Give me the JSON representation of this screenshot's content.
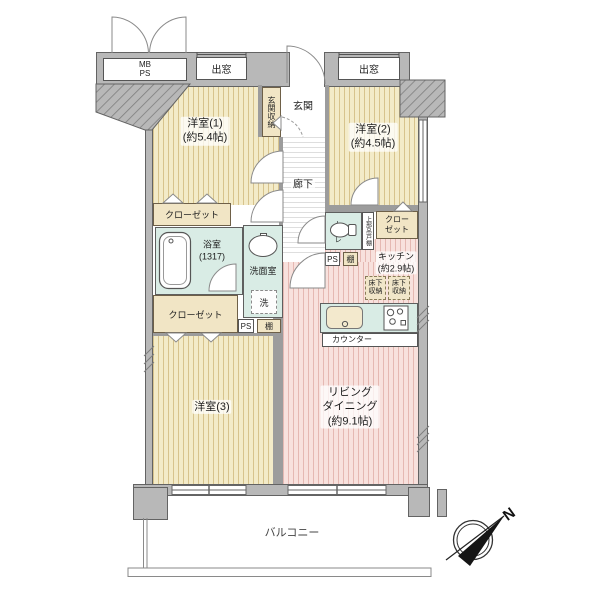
{
  "floorplan": {
    "rooms": {
      "room1": {
        "name": "洋室(1)",
        "size": "(約5.4帖)"
      },
      "room2": {
        "name": "洋室(2)",
        "size": "(約4.5帖)"
      },
      "room3": {
        "name": "洋室(3)"
      },
      "living": {
        "name_line1": "リビング",
        "name_line2": "ダイニング",
        "size": "(約9.1帖)"
      },
      "kitchen": {
        "name": "キッチン",
        "size": "(約2.9帖)"
      },
      "bath": {
        "name": "浴室",
        "size": "(1317)"
      },
      "washroom": {
        "name": "洗面室"
      },
      "toilet": {
        "name": "トイレ"
      },
      "entrance": {
        "name": "玄関"
      },
      "hallway": {
        "name": "廊下"
      },
      "balcony": {
        "name": "バルコニー"
      }
    },
    "fixtures": {
      "meter_box": {
        "line1": "MB",
        "line2": "PS"
      },
      "bay_window_left": "出窓",
      "bay_window_right": "出窓",
      "entrance_storage": "玄関収納",
      "closet_room1": "クローゼット",
      "closet_room3": "クローゼット",
      "closet_room2": {
        "line1": "クロー",
        "line2": "ゼット"
      },
      "upper_cabinet": "上部吊戸棚",
      "laundry": "洗",
      "ps_upper": "PS",
      "ps_lower": "PS",
      "shelf_upper": "棚",
      "shelf_lower": "棚",
      "underfloor_left": {
        "line1": "床下",
        "line2": "収納"
      },
      "underfloor_right": {
        "line1": "床下",
        "line2": "収納"
      },
      "counter": "カウンター"
    },
    "compass": {
      "north": "N"
    },
    "colors": {
      "wall": "#b8b8b8",
      "wall_outline": "#636363",
      "floor_wood": "#f3ebc8",
      "floor_wood_stripe": "#d7c38c",
      "floor_pink": "#f8e1dd",
      "floor_pink_stripe": "#e5b8b2",
      "wet_area": "#d9ece5",
      "closet_fill": "#f1e5c5",
      "line": "#555555"
    }
  }
}
